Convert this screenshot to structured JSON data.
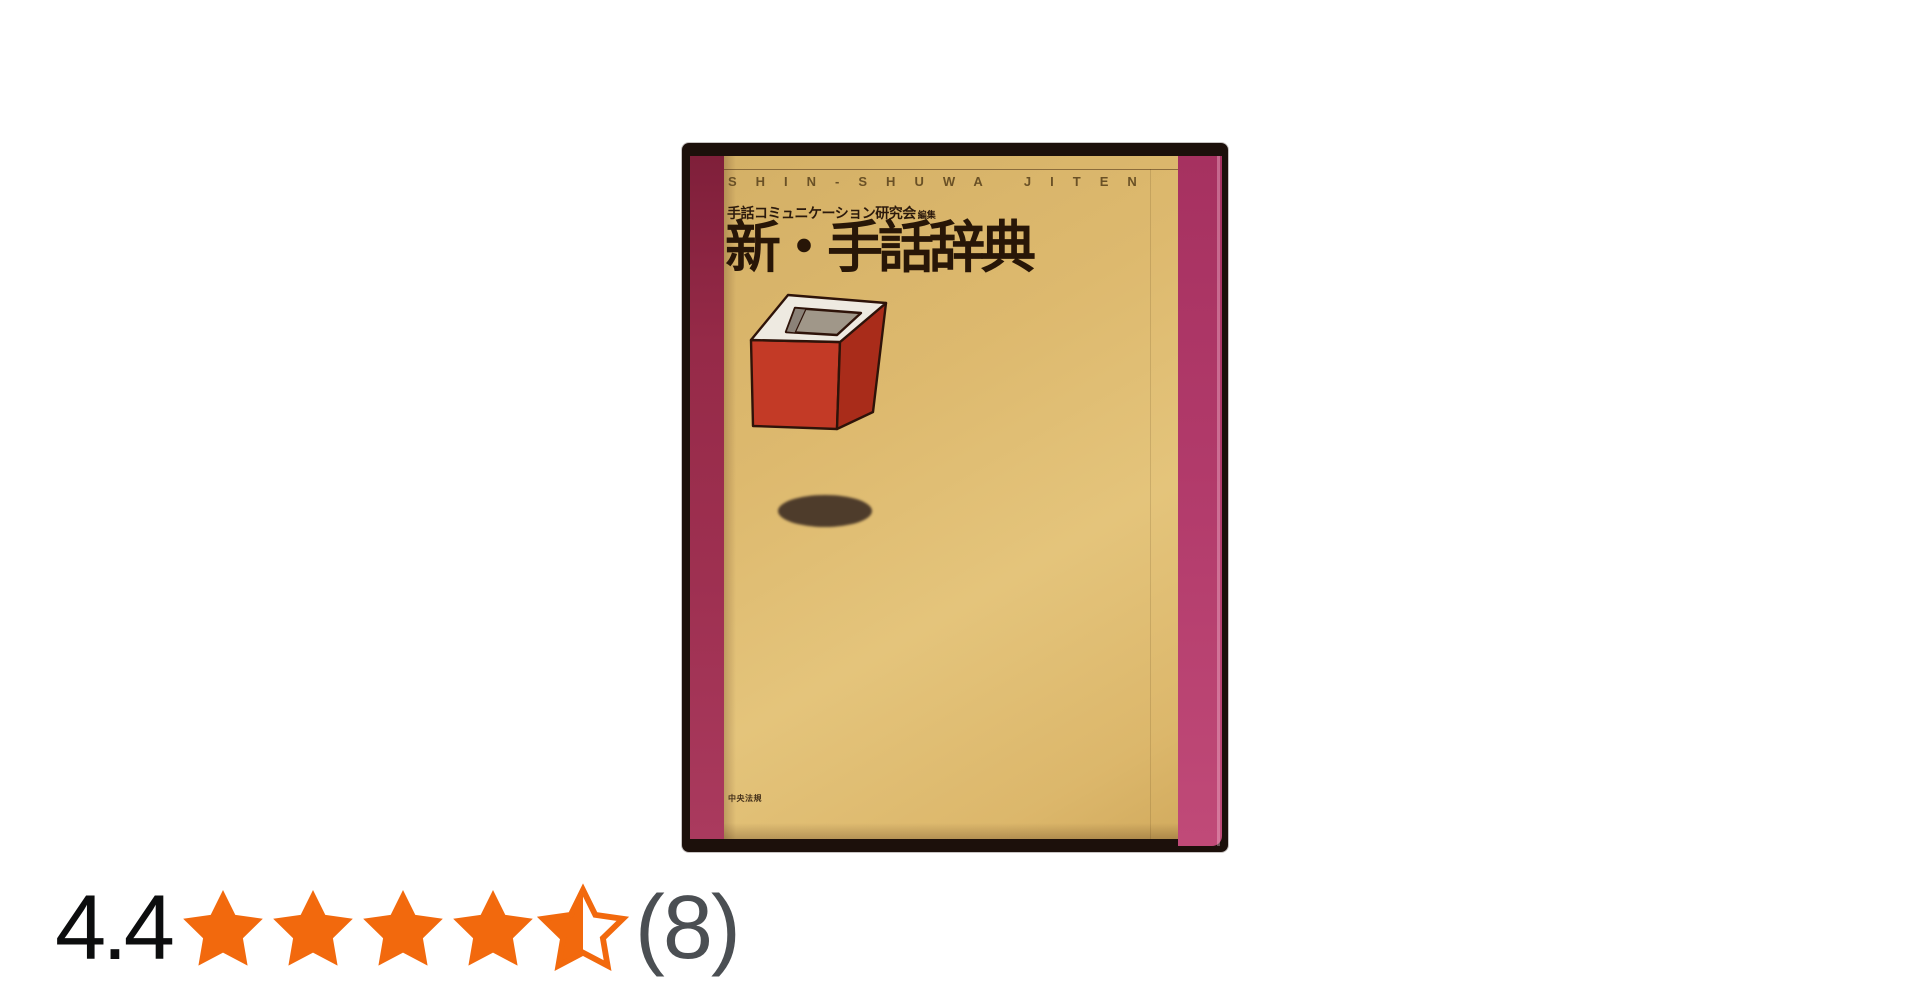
{
  "book": {
    "top_caption": "SHIN-SHUWA JITEN",
    "author": "手話コミュニケーション研究会",
    "editor_suffix": "編集",
    "title": "新・手話辞典",
    "publisher": "中央法規",
    "colors": {
      "spine_maroon": "#962a48",
      "right_band_magenta": "#b13a6a",
      "cover_tan": "#ddb96e",
      "frame_dark": "#1c100b",
      "cube_front_red": "#c33a26",
      "cube_side_red": "#a92c1a",
      "cube_top_white": "#eeeae1",
      "shadow_brown": "#4e3c2b",
      "title_text": "#281607"
    }
  },
  "rating": {
    "score": "4.4",
    "max_stars": 5,
    "stars_filled": 4.5,
    "count_display": "(8)",
    "star_color": "#f2690d",
    "count_color": "#4b4f53"
  }
}
